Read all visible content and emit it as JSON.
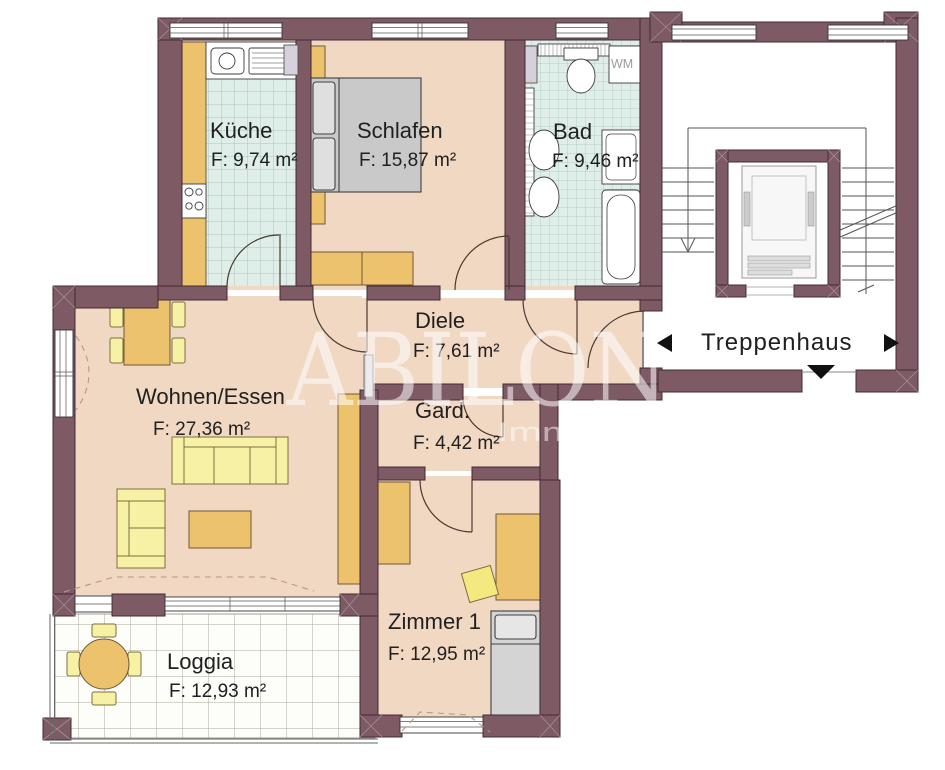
{
  "watermark": {
    "brand": "ABILON",
    "word": "Immobilien"
  },
  "rooms": {
    "kueche": {
      "name": "Küche",
      "area": "F: 9,74 m²"
    },
    "schlafen": {
      "name": "Schlafen",
      "area": "F: 15,87 m²"
    },
    "bad": {
      "name": "Bad",
      "area": "F: 9,46 m²"
    },
    "diele": {
      "name": "Diele",
      "area": "F: 7,61 m²"
    },
    "gard": {
      "name": "Gard.",
      "area": "F: 4,42 m²"
    },
    "wohnen": {
      "name": "Wohnen/Essen",
      "area": "F: 27,36 m²"
    },
    "zimmer1": {
      "name": "Zimmer 1",
      "area": "F: 12,95 m²"
    },
    "loggia": {
      "name": "Loggia",
      "area": "F: 12,93 m²"
    },
    "treppenhaus": {
      "name": "Treppenhaus"
    }
  },
  "appliances": {
    "washing_machine": "WM"
  },
  "colors": {
    "wall": "#7d5a64",
    "floor": "#f1d8c3",
    "wet_tile": "#e0eee9",
    "furniture_wood": "#ecc36c",
    "furniture_upholstery": "#f6f1a4",
    "bed_gray": "#c9c9c9",
    "watermark": "#ffffff"
  }
}
